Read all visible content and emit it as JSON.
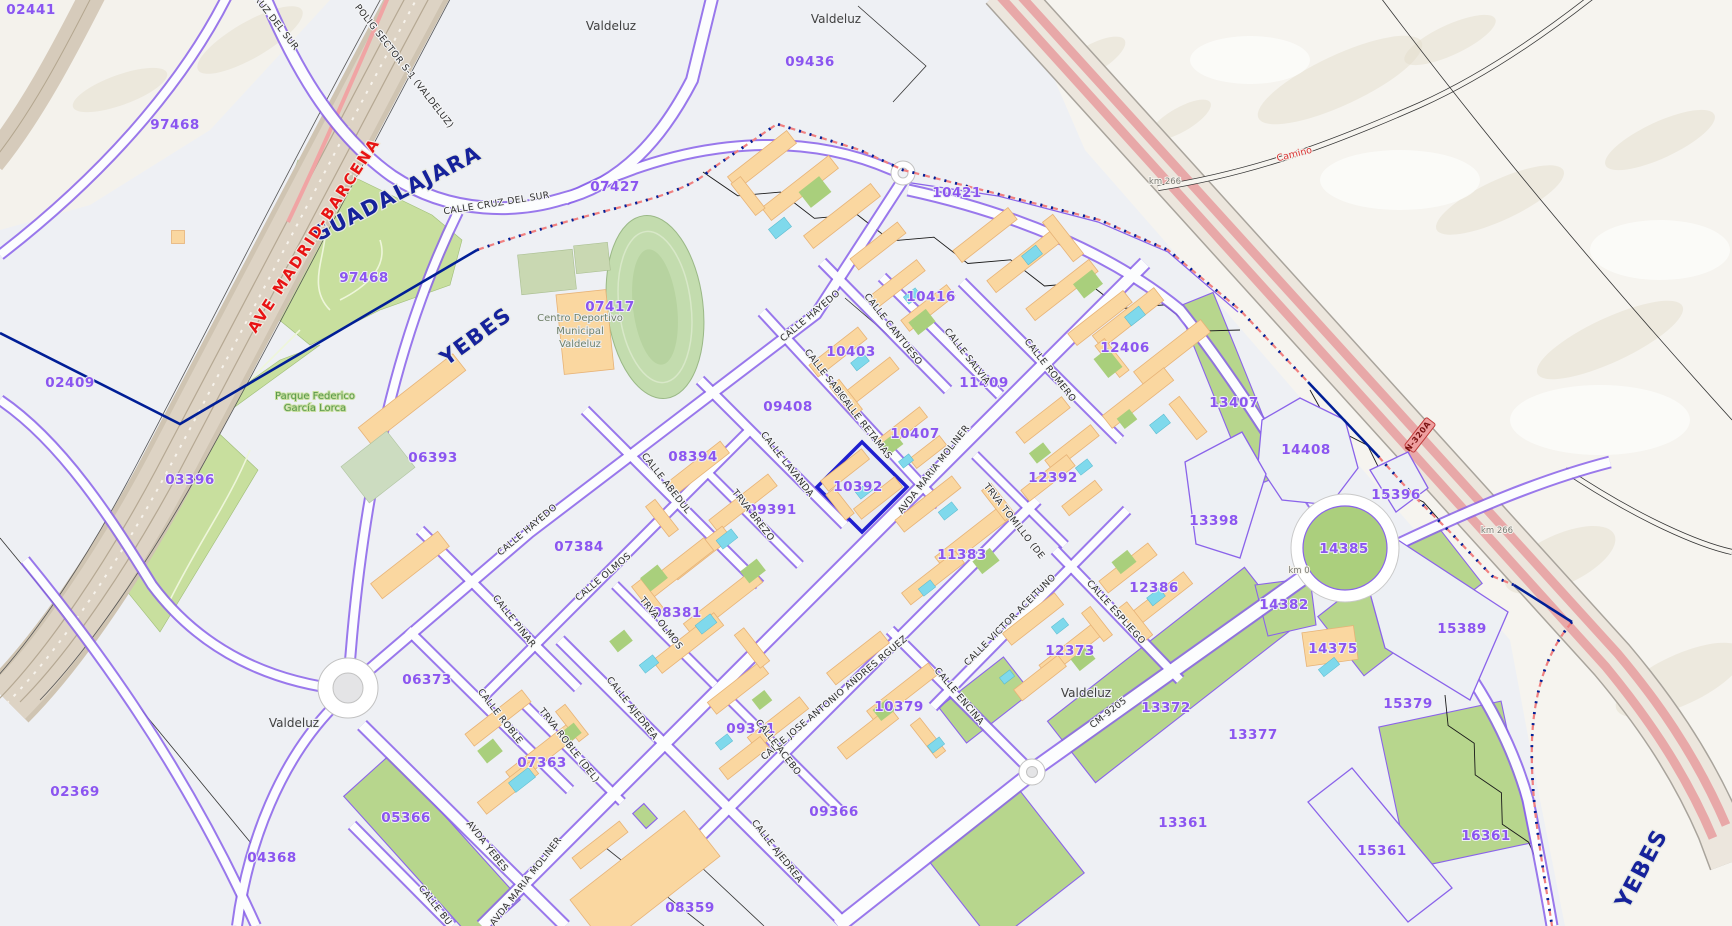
{
  "map": {
    "selected_parcel": "10392",
    "palette": {
      "parcel_number": "#8b55f0",
      "street_text": "#2d2d2d",
      "municipality_text": "#16229b",
      "railway_text": "#e81313",
      "camino_text": "#d93030",
      "park_text": "#58974d",
      "sports_text": "#6f8068",
      "selected_outline": "#1f1fcf",
      "parcel_line": "#8a63ea",
      "park_green": "#c8df9e",
      "building_orange": "#fad7a0",
      "pool_cyan": "#7fd9ec",
      "road_pink": "#e8a8a8",
      "boundary_pink": "#f08080",
      "boundary_navy": "#001e96"
    },
    "parcel_labels": [
      {
        "text": "02441",
        "x": 31,
        "y": 14
      },
      {
        "text": "97468",
        "x": 175,
        "y": 129
      },
      {
        "text": "97468",
        "x": 364,
        "y": 282
      },
      {
        "text": "02409",
        "x": 70,
        "y": 387
      },
      {
        "text": "03396",
        "x": 190,
        "y": 484
      },
      {
        "text": "06393",
        "x": 433,
        "y": 462
      },
      {
        "text": "07427",
        "x": 615,
        "y": 191
      },
      {
        "text": "09436",
        "x": 810,
        "y": 66
      },
      {
        "text": "07417",
        "x": 610,
        "y": 311
      },
      {
        "text": "10421",
        "x": 957,
        "y": 197
      },
      {
        "text": "10416",
        "x": 931,
        "y": 301
      },
      {
        "text": "10403",
        "x": 851,
        "y": 356
      },
      {
        "text": "11409",
        "x": 984,
        "y": 387
      },
      {
        "text": "12406",
        "x": 1125,
        "y": 352
      },
      {
        "text": "13407",
        "x": 1234,
        "y": 407
      },
      {
        "text": "14408",
        "x": 1306,
        "y": 454
      },
      {
        "text": "15396",
        "x": 1396,
        "y": 499
      },
      {
        "text": "09408",
        "x": 788,
        "y": 411
      },
      {
        "text": "08394",
        "x": 693,
        "y": 461
      },
      {
        "text": "10392",
        "x": 858,
        "y": 491
      },
      {
        "text": "10407",
        "x": 915,
        "y": 438
      },
      {
        "text": "12392",
        "x": 1053,
        "y": 482
      },
      {
        "text": "13398",
        "x": 1214,
        "y": 525
      },
      {
        "text": "14385",
        "x": 1344,
        "y": 553
      },
      {
        "text": "07384",
        "x": 579,
        "y": 551
      },
      {
        "text": "09391",
        "x": 772,
        "y": 514
      },
      {
        "text": "11383",
        "x": 962,
        "y": 559
      },
      {
        "text": "12386",
        "x": 1154,
        "y": 592
      },
      {
        "text": "14382",
        "x": 1284,
        "y": 609
      },
      {
        "text": "15389",
        "x": 1462,
        "y": 633
      },
      {
        "text": "08381",
        "x": 677,
        "y": 617
      },
      {
        "text": "12373",
        "x": 1070,
        "y": 655
      },
      {
        "text": "14375",
        "x": 1333,
        "y": 653
      },
      {
        "text": "06373",
        "x": 427,
        "y": 684
      },
      {
        "text": "10379",
        "x": 899,
        "y": 711
      },
      {
        "text": "13372",
        "x": 1166,
        "y": 712
      },
      {
        "text": "13377",
        "x": 1253,
        "y": 739
      },
      {
        "text": "15379",
        "x": 1408,
        "y": 708
      },
      {
        "text": "09371",
        "x": 751,
        "y": 733
      },
      {
        "text": "07363",
        "x": 542,
        "y": 767
      },
      {
        "text": "02369",
        "x": 75,
        "y": 796
      },
      {
        "text": "05366",
        "x": 406,
        "y": 822
      },
      {
        "text": "04368",
        "x": 272,
        "y": 862
      },
      {
        "text": "09366",
        "x": 834,
        "y": 816
      },
      {
        "text": "13361",
        "x": 1183,
        "y": 827
      },
      {
        "text": "15361",
        "x": 1382,
        "y": 855
      },
      {
        "text": "16361",
        "x": 1486,
        "y": 840
      },
      {
        "text": "08359",
        "x": 690,
        "y": 912
      }
    ],
    "street_labels": [
      {
        "text": "CRUZ DEL SUR",
        "x": 272,
        "y": 22,
        "rot": 52
      },
      {
        "text": "POLIG SECTOR S-1 (VALDELUZ)",
        "x": 402,
        "y": 68,
        "rot": 52
      },
      {
        "text": "CALLE CRUZ DEL SUR",
        "x": 497,
        "y": 206,
        "rot": -9
      },
      {
        "text": "CALLE HAYEDO",
        "x": 812,
        "y": 318,
        "rot": -40
      },
      {
        "text": "CALLE HAYEDO",
        "x": 529,
        "y": 532,
        "rot": -40
      },
      {
        "text": "CALLE CANTUESO",
        "x": 891,
        "y": 331,
        "rot": 52
      },
      {
        "text": "CALLE SABINA",
        "x": 826,
        "y": 380,
        "rot": 52
      },
      {
        "text": "CALLE SALVIA",
        "x": 965,
        "y": 358,
        "rot": 52
      },
      {
        "text": "CALLE ROMERO",
        "x": 1048,
        "y": 372,
        "rot": 52
      },
      {
        "text": "CALLE RETAMAS",
        "x": 863,
        "y": 428,
        "rot": 52
      },
      {
        "text": "CALLE LAVANDA",
        "x": 785,
        "y": 466,
        "rot": 52
      },
      {
        "text": "AVDA MARIA MOLINER",
        "x": 936,
        "y": 471,
        "rot": -52
      },
      {
        "text": "AVDA MARIA MOLINER",
        "x": 528,
        "y": 883,
        "rot": -52
      },
      {
        "text": "TRVA TOMILLO (DE",
        "x": 1012,
        "y": 523,
        "rot": 52
      },
      {
        "text": "CALLE ABEDUL",
        "x": 664,
        "y": 485,
        "rot": 52
      },
      {
        "text": "TRVA BREZO",
        "x": 751,
        "y": 517,
        "rot": 52
      },
      {
        "text": "CALLE OLMOS",
        "x": 605,
        "y": 579,
        "rot": -40
      },
      {
        "text": "TRVA OLMOS",
        "x": 659,
        "y": 625,
        "rot": 52
      },
      {
        "text": "CALLE PINAR",
        "x": 512,
        "y": 623,
        "rot": 52
      },
      {
        "text": "CALLE ROBLE",
        "x": 498,
        "y": 718,
        "rot": 52
      },
      {
        "text": "TRVA ROBLE (DEL)",
        "x": 567,
        "y": 747,
        "rot": 52
      },
      {
        "text": "CALLE AJEDREA",
        "x": 630,
        "y": 710,
        "rot": 52
      },
      {
        "text": "CALLE AJEDREA",
        "x": 775,
        "y": 853,
        "rot": 52
      },
      {
        "text": "CALLE JOSE ANTONIO ANDRES RGUEZ",
        "x": 836,
        "y": 700,
        "rot": -40
      },
      {
        "text": "CALLE ACEBO",
        "x": 776,
        "y": 749,
        "rot": 52
      },
      {
        "text": "CALLE ENCINA",
        "x": 957,
        "y": 698,
        "rot": 50
      },
      {
        "text": "CALLE VICTOR ACEITUNO",
        "x": 1012,
        "y": 622,
        "rot": -45
      },
      {
        "text": "CALLE ESPLIEGO",
        "x": 1114,
        "y": 614,
        "rot": 48
      },
      {
        "text": "AVDA YEBES",
        "x": 485,
        "y": 848,
        "rot": 52
      },
      {
        "text": "CALLE BU",
        "x": 433,
        "y": 907,
        "rot": 52
      },
      {
        "text": "CM-9205",
        "x": 1110,
        "y": 715,
        "rot": -38
      }
    ],
    "town_labels": [
      {
        "text": "Valdeluz",
        "x": 611,
        "y": 30
      },
      {
        "text": "Valdeluz",
        "x": 836,
        "y": 23
      },
      {
        "text": "Valdeluz",
        "x": 294,
        "y": 727
      },
      {
        "text": "Valdeluz",
        "x": 1086,
        "y": 697
      }
    ],
    "municipality_labels": [
      {
        "text": "GUADALAJARA",
        "x": 400,
        "y": 200,
        "rot": -27,
        "size": 21
      },
      {
        "text": "YEBES",
        "x": 480,
        "y": 342,
        "rot": -36,
        "size": 21
      },
      {
        "text": "YEBES",
        "x": 1648,
        "y": 872,
        "rot": -62,
        "size": 22
      }
    ],
    "railway_label": {
      "text": "AVE  MADRID-BARCENA",
      "x": 318,
      "y": 238,
      "rot": -57
    },
    "camino_label": {
      "text": "Camino",
      "x": 1295,
      "y": 157,
      "rot": -14
    },
    "km_labels": [
      {
        "text": "km 266",
        "x": 1165,
        "y": 184
      },
      {
        "text": "km 266",
        "x": 1497,
        "y": 533
      },
      {
        "text": "km 0",
        "x": 1299,
        "y": 573
      }
    ],
    "road_sign": {
      "text": "N-320A",
      "x": 1420,
      "y": 435,
      "rot": -52
    },
    "park_label": {
      "lines": [
        "Parque Federico",
        "García Lorca"
      ],
      "x": 315,
      "y": 399
    },
    "sports_label": {
      "lines": [
        "Centro Deportivo",
        "Municipal",
        "Valdeluz"
      ],
      "x": 580,
      "y": 321
    }
  }
}
